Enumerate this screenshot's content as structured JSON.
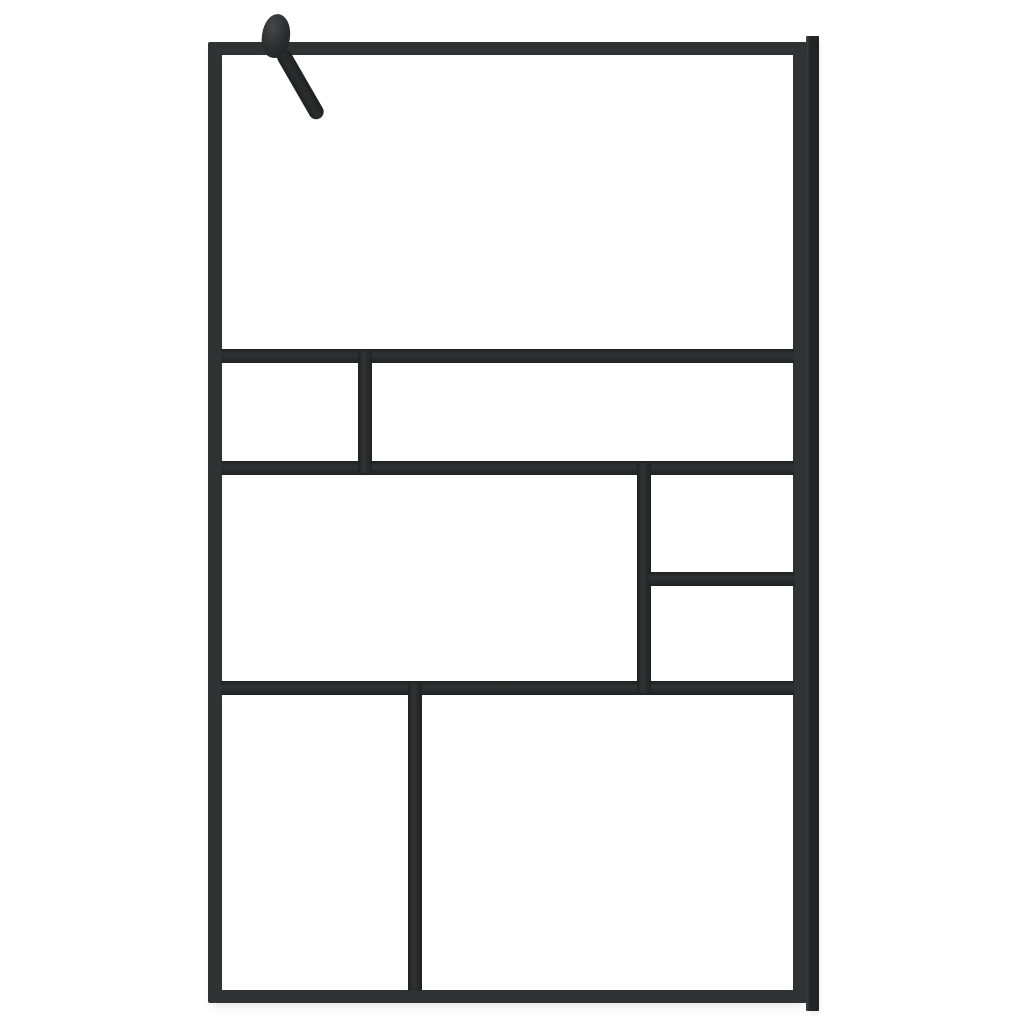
{
  "image": {
    "kind": "product-photo",
    "alt": "Walk-in shower screen: clear glass with black Mondrian-style grid frame, wall support arm at top left and wall profile rail on the right edge",
    "visible_text": ""
  },
  "colors": {
    "background": "#ffffff",
    "frame": "#303234",
    "frame_dark": "#1f2123",
    "frame_highlight": "#45474a",
    "hardware": "#2a2c2e",
    "wall_profile": "#242628",
    "glass": "#ffffff",
    "shadow": "rgba(0,0,0,0.12)"
  },
  "parts": {
    "outer_frame": "black aluminium outer frame",
    "wall_profile": "vertical wall mounting profile, right side",
    "mount_knob": "round wall-bracket knob, top left",
    "support_arm": "diagonal stabilizer arm from knob to glass",
    "glass_panels": [
      "glass-top",
      "glass-mid-left",
      "glass-mid-right",
      "glass-center",
      "glass-right-upper",
      "glass-right-lower",
      "glass-bottom-left",
      "glass-bottom-right"
    ]
  }
}
